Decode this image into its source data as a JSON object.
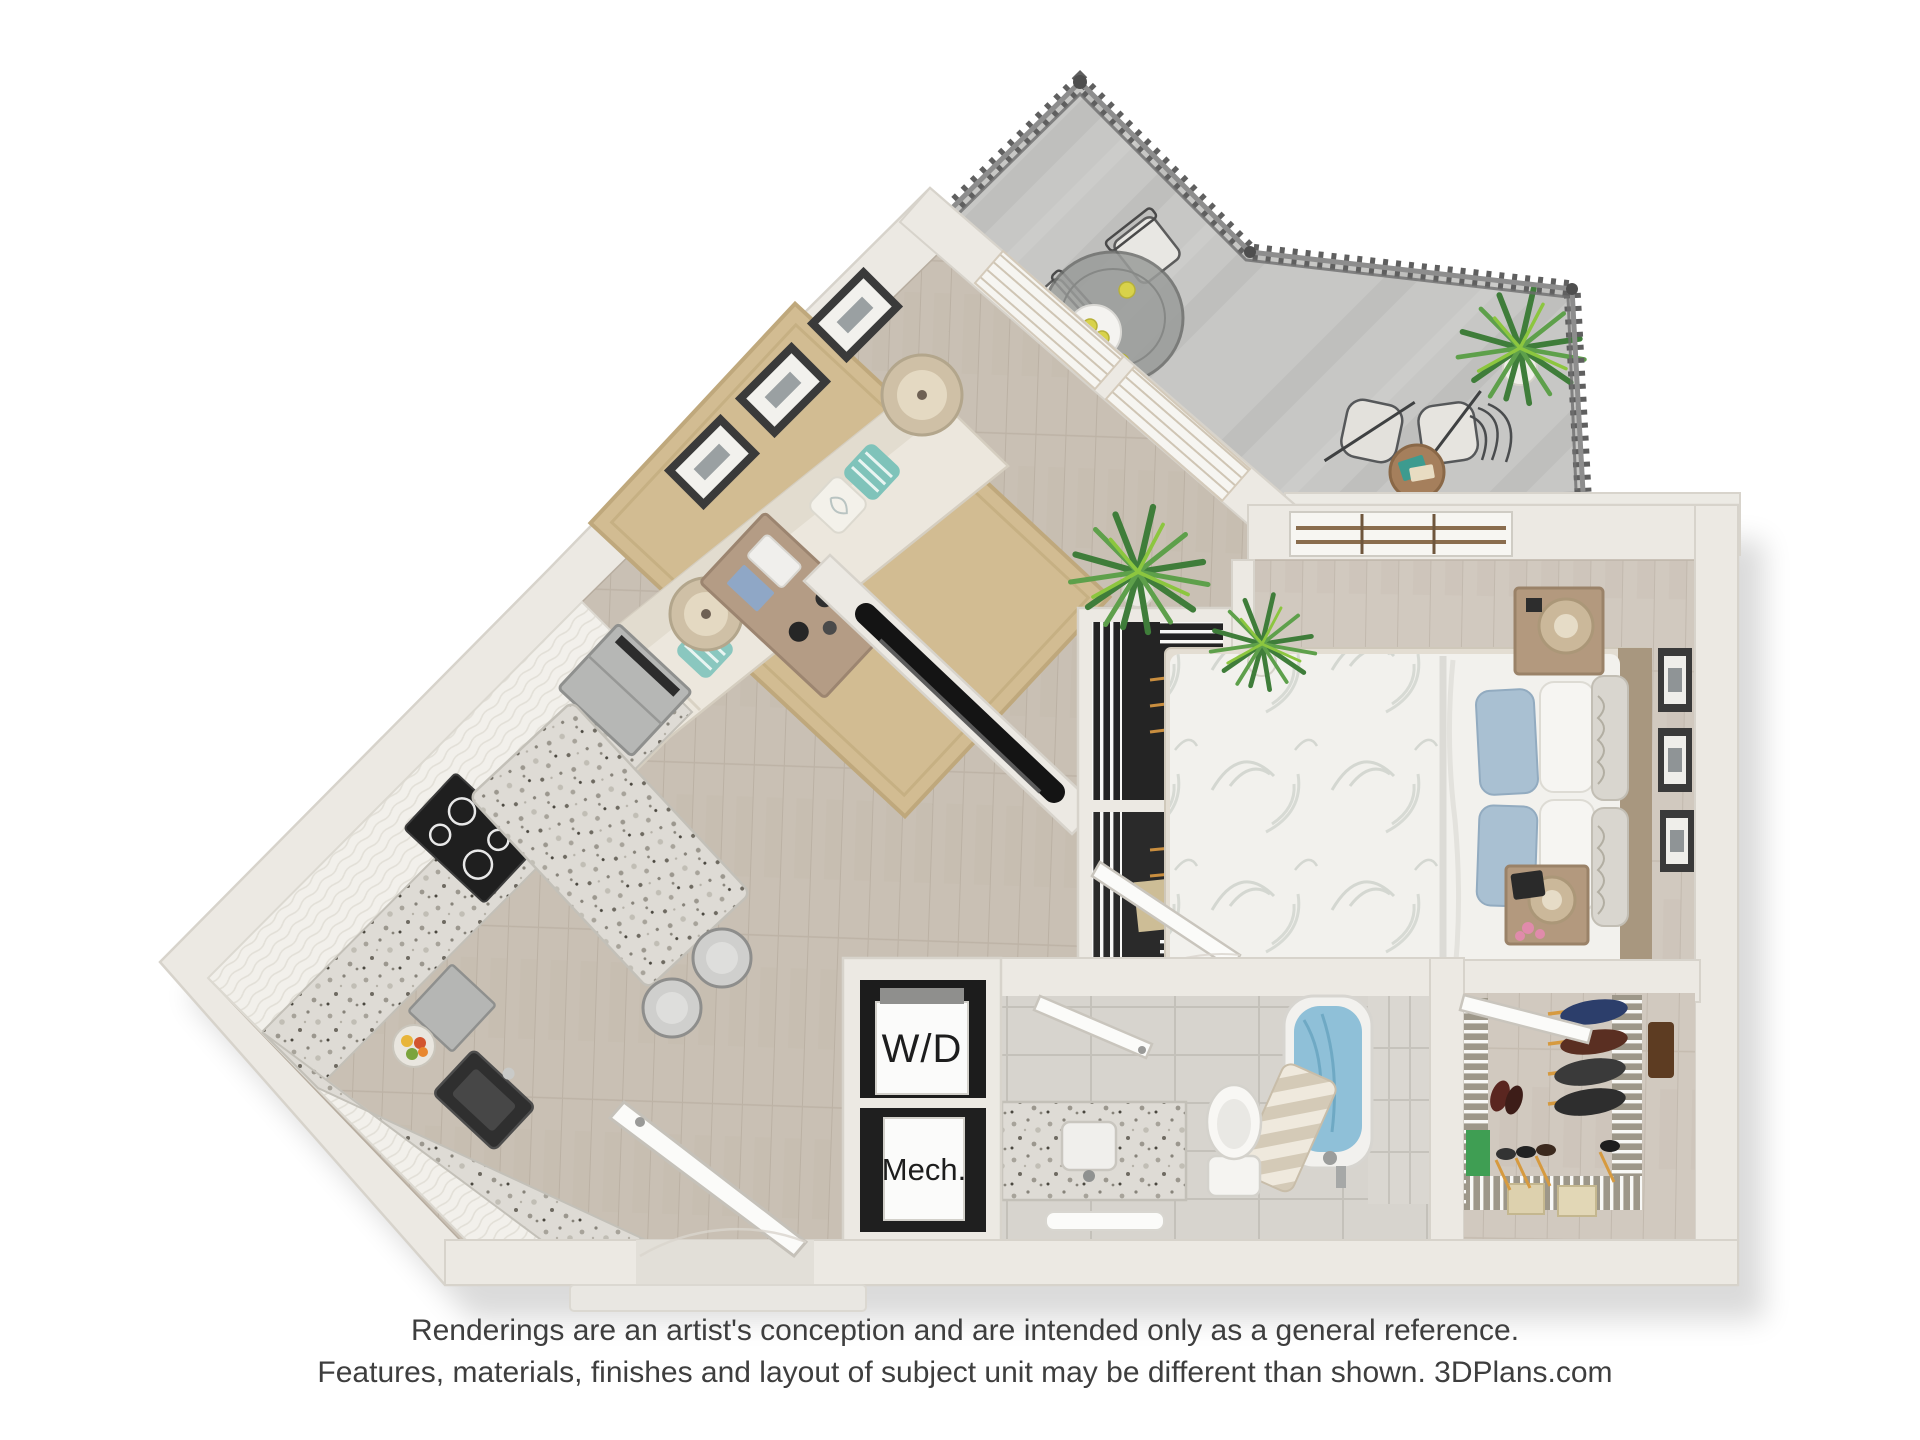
{
  "labels": {
    "washer_dryer": "W/D",
    "mechanical": "Mech."
  },
  "disclaimer": {
    "line1": "Renderings are an artist's conception and are intended only as a general reference.",
    "line2": "Features, materials, finishes and layout of subject unit may be different than shown. 3DPlans.com"
  },
  "palette": {
    "page_background": "#ffffff",
    "wall": "#ece9e3",
    "wall_edge": "#d7d3cb",
    "wood_floor_main": "#c9c0b4",
    "wood_floor_bedroom": "#d1c9bf",
    "balcony_concrete": "#c7c7c5",
    "railing_dark": "#5a5a5a",
    "granite_counter": "#dedbd5",
    "cabinet_white": "#f2f0eb",
    "sofa_cream": "#ece7dd",
    "rug_jute": "#d2bc92",
    "pillow_teal": "#7fc3ba",
    "pillow_blue": "#a9c0d2",
    "tub_blue": "#8fc0d8",
    "closet_interior_dark": "#242424",
    "plant_green": "#4e8f46",
    "appliance_steel": "#b6b7b5",
    "label_text": "#1d1d1d",
    "disclaimer_text": "#3e3e3e"
  },
  "scene": {
    "type": "3d-floor-plan-rendering",
    "rooms": [
      "balcony",
      "living-room",
      "kitchen",
      "bedroom",
      "bathroom",
      "walk-in-closet",
      "laundry-closet",
      "mechanical-closet",
      "entry"
    ],
    "balcony_items": [
      "metal-railing",
      "round-glass-dining-table",
      "patio-chairs",
      "lemons-and-plate",
      "lounge-chairs",
      "wood-side-table",
      "potted-plant"
    ],
    "living_items": [
      "cream-sectional-sofa",
      "teal-striped-pillows",
      "two-drum-lamps",
      "three-wall-frames",
      "jute-rug",
      "wood-coffee-table",
      "tv-wall",
      "boston-fern"
    ],
    "kitchen_items": [
      "stainless-fridge",
      "black-cooktop",
      "granite-l-counter",
      "sink",
      "dishwasher",
      "fruit-bowl",
      "granite-island",
      "two-stools"
    ],
    "bedroom_items": [
      "bed-floral-duvet",
      "blue-white-pillows",
      "two-nightstands",
      "two-lamps",
      "tablet",
      "pink-flowers",
      "window",
      "three-wall-frames",
      "yucca-plant"
    ],
    "bathroom_items": [
      "granite-vanity",
      "sink",
      "towel",
      "toilet",
      "shower-curtain",
      "blue-bathtub",
      "tile-floor"
    ],
    "closet_items": [
      "wire-shelving",
      "hanging-clothes",
      "orange-hangers",
      "shoes",
      "green-bin",
      "storage-boxes"
    ]
  }
}
